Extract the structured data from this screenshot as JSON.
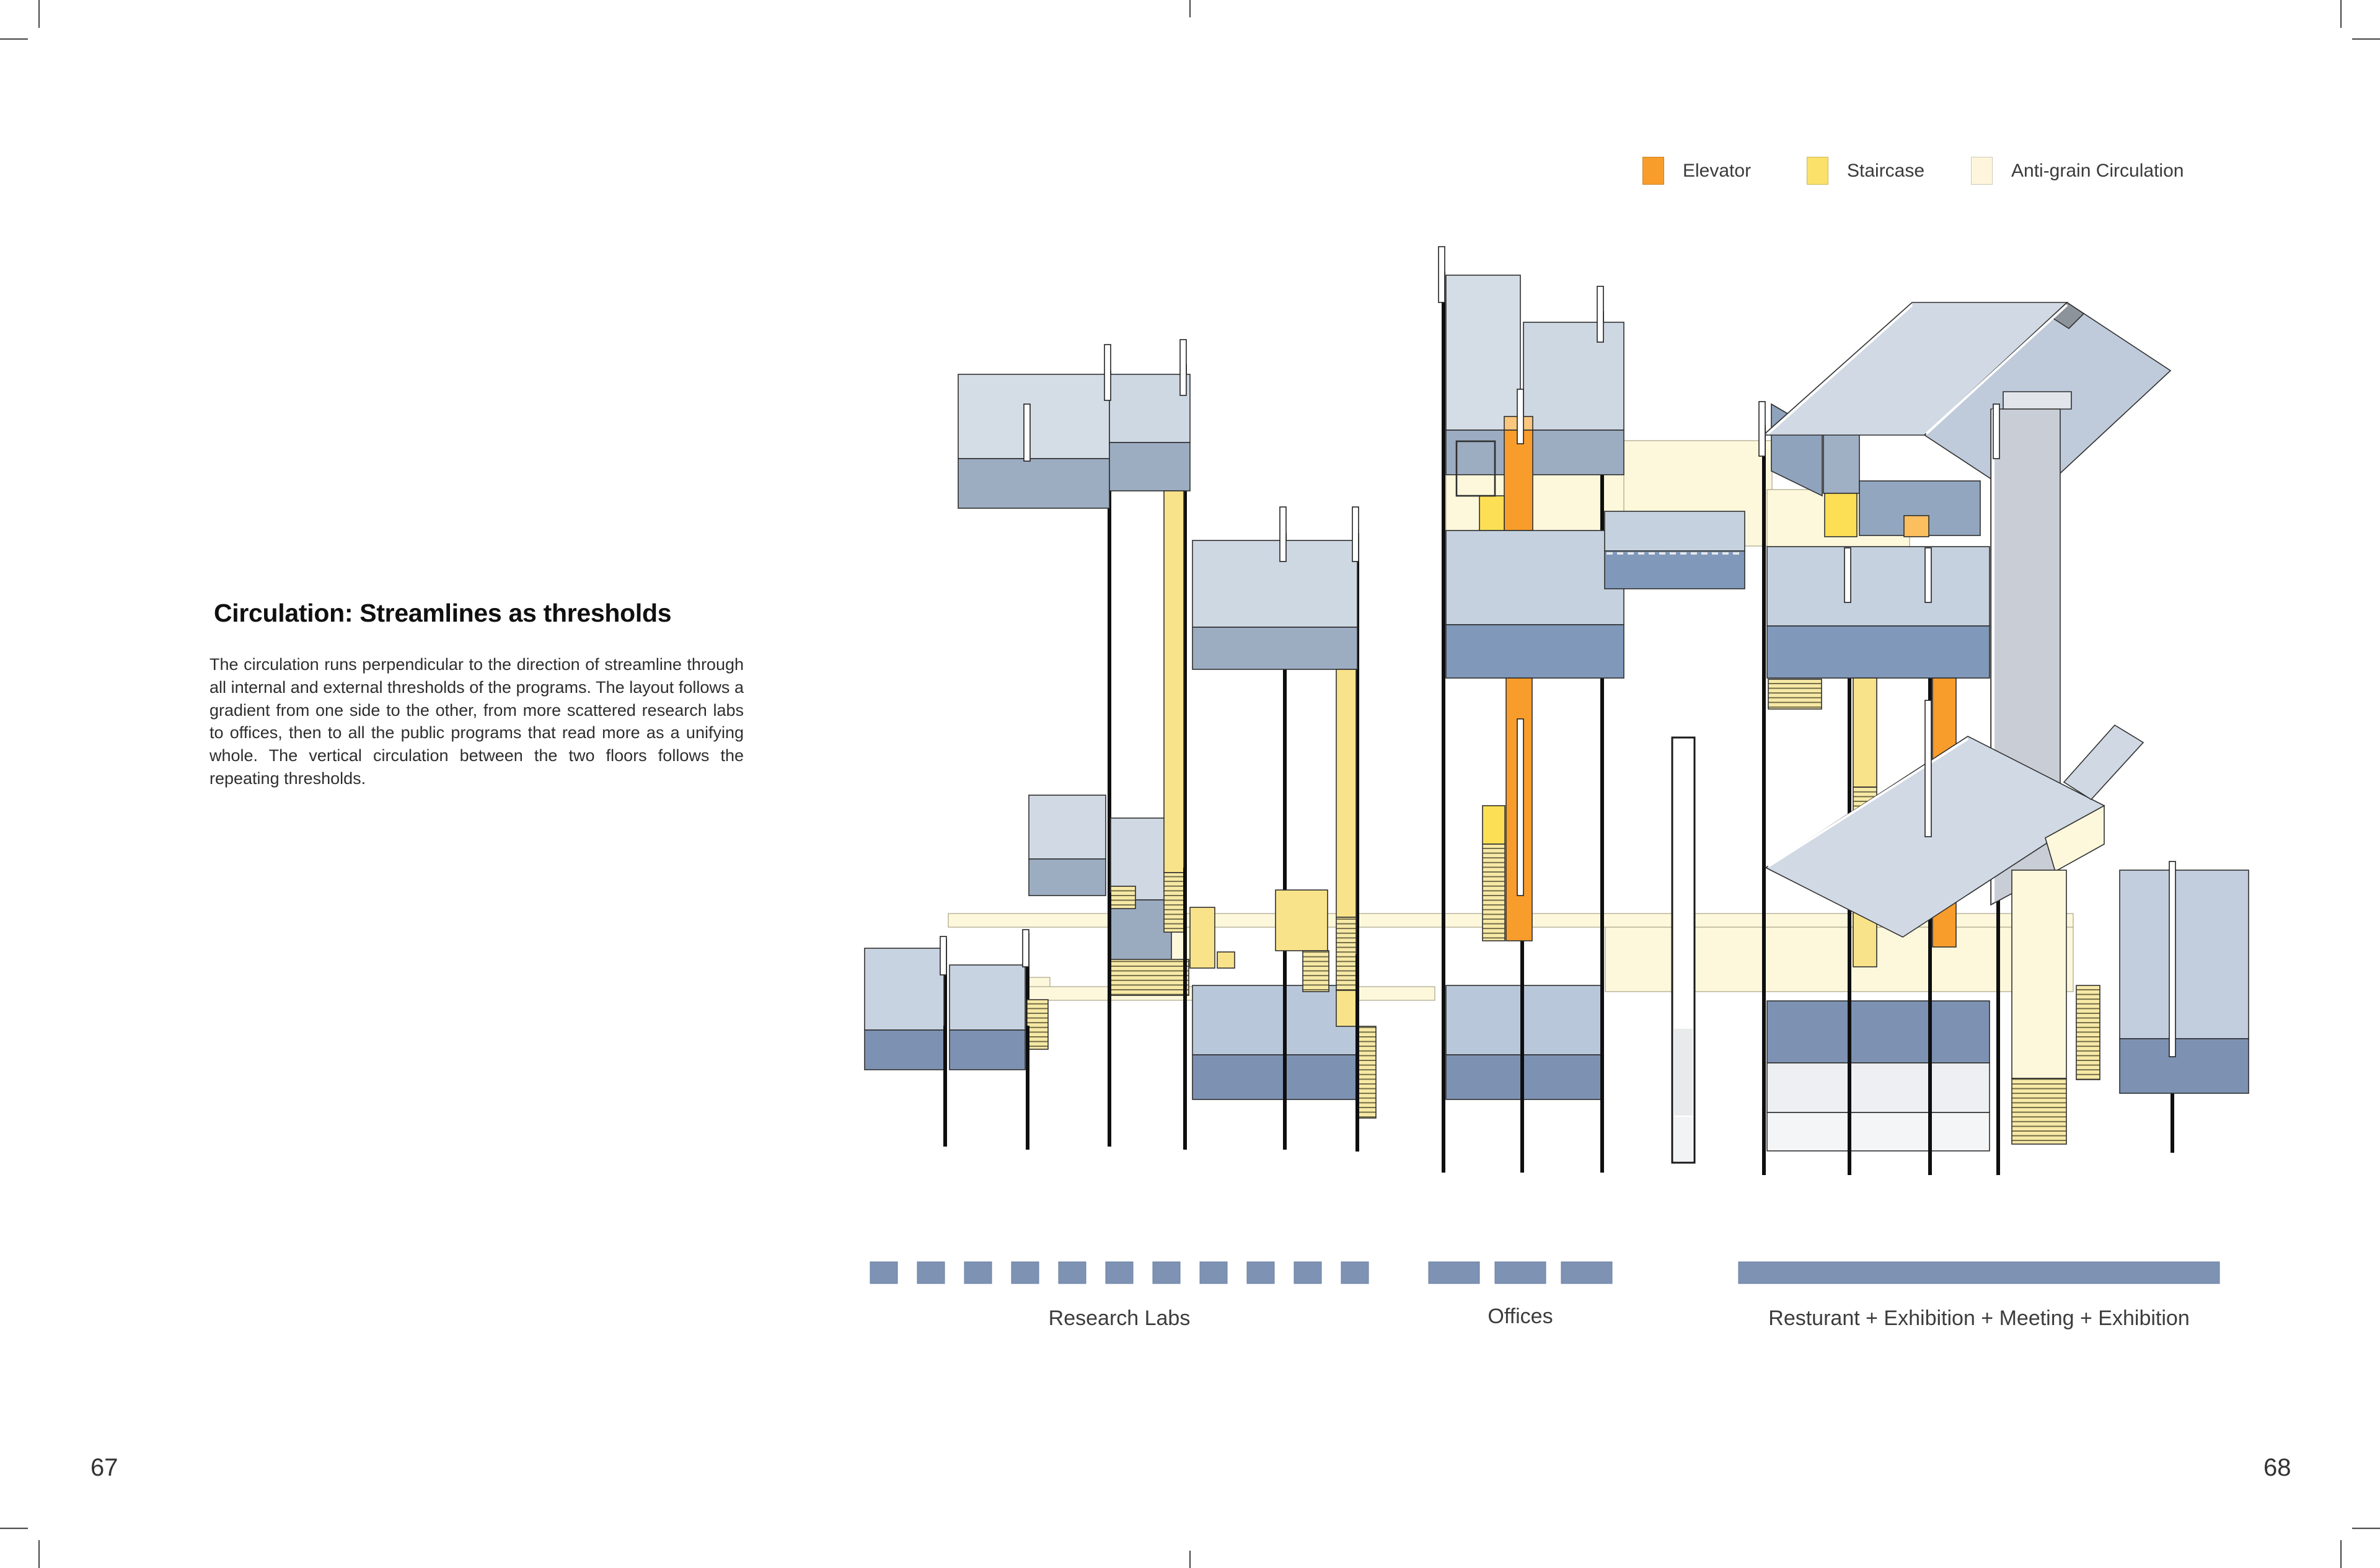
{
  "article": {
    "title": "Circulation: Streamlines as thresholds",
    "body": "The circulation runs perpendicular to the direction of streamline through all internal and external thresholds of the programs. The layout follows a gradient from one side to the other, from more scattered research labs to offices, then to all the public programs that read more as a unifying whole. The vertical circulation between the two floors follows the repeating thresholds."
  },
  "legend": {
    "items": [
      {
        "label": "Elevator",
        "color": "#F89D2B"
      },
      {
        "label": "Staircase",
        "color": "#FBE06A"
      },
      {
        "label": "Anti-grain Circulation",
        "color": "#FDF6DC"
      }
    ]
  },
  "programs": {
    "bar_color": "#7E92B4",
    "items": [
      {
        "label": "Research Labs",
        "units": 11,
        "bar_style": "dashed-small"
      },
      {
        "label": "Offices",
        "units": 3,
        "bar_style": "dashed-wide"
      },
      {
        "label": "Resturant + Exhibition + Meeting + Exhibition",
        "units": 1,
        "bar_style": "solid"
      }
    ]
  },
  "pages": {
    "left_number": "67",
    "right_number": "68"
  },
  "diagram_colors": {
    "slab_light": "#D4DDE6",
    "slab_medium": "#9CADC2",
    "slab_blue": "#B9C7DA",
    "band_dark": "#7D92B3",
    "circulation_cream": "#FDF8DC",
    "staircase_yellow": "#F9E38A",
    "elevator_orange": "#F89D2B",
    "column_black": "#0F0F0F"
  }
}
